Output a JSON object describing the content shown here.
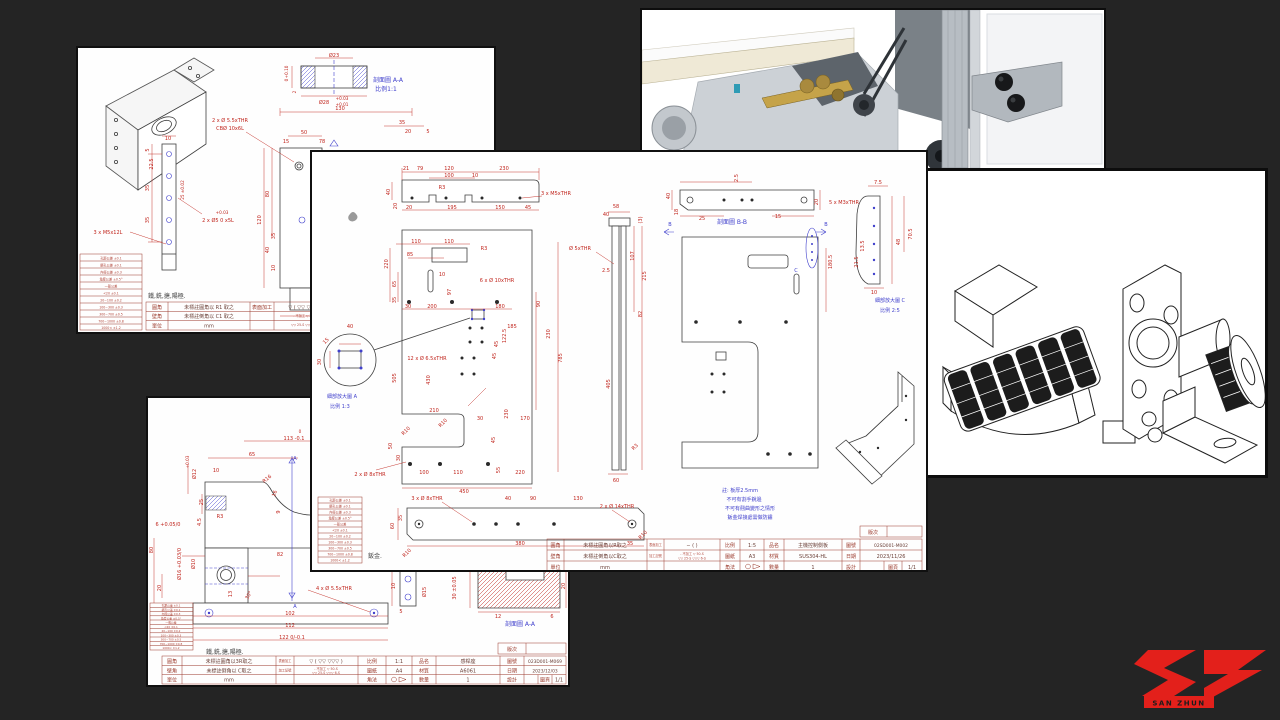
{
  "colors": {
    "background": "#242424",
    "dim_red": "#c0241c",
    "label_blue": "#4040cc",
    "title_maroon": "#9a382a",
    "logo_red": "#e3201b"
  },
  "tol_table": {
    "rows": [
      "孔距公差 ±0.1",
      "鑽孔公差 ±0.1",
      "內徑公差 ±0.3",
      "角度公差 ±0.5°",
      "一般公差",
      "<20 ±0.1",
      "20~100 ±0.2",
      "100~300 ±0.3",
      "300~700 ±0.5",
      "700~1000 ±0.8",
      "1000< ±1.2"
    ]
  },
  "title_labels": {
    "fillet": "圓角",
    "chamfer": "壁角",
    "unit": "單位",
    "surface": "表面加工",
    "machining": "加工記號",
    "scale": "比例",
    "paper": "圖紙",
    "angle": "角法",
    "part": "品名",
    "material": "材質",
    "qty": "數量",
    "dwg_no": "圖號",
    "date": "日期",
    "design": "設計",
    "page": "圖頁",
    "rev": "版次",
    "surface_sym": "▽ ( ▽▽ ▽▽▽ )",
    "codes_a": "- 不加工  ▽ 50-S",
    "codes_b": "▽▽ 25-S  ▽▽▽ 6-S"
  },
  "sheet_top_left": {
    "section_label": "剖面圖 A-A",
    "section_scale": "比例1:1",
    "process_note": "鐵,銑,搪,陽極.",
    "dims_section": [
      "Ø23",
      "+0.10",
      "0",
      "2",
      "Ø28",
      "+0.03",
      "+0.01"
    ],
    "dims_top": [
      "130",
      "50",
      "15",
      "78",
      "35",
      "20",
      "5"
    ],
    "dims_callouts": [
      "2 x Ø 5.5xTHR",
      "CBØ 10x6L",
      "3 x M5x12L",
      "+0.03",
      "2 x Ø5 0  x5L"
    ],
    "dims_strip": [
      "10",
      "5",
      "22.5",
      "35",
      "35",
      "25 ±0.02"
    ],
    "dims_main": [
      "120",
      "80",
      "40",
      "35",
      "10",
      "51 ±0.02",
      "45",
      "19",
      "R7",
      "7",
      "22"
    ],
    "title": {
      "fillet_val": "未標註圓角以 R1 取之",
      "chamfer_val": "未標註倒角以 C1 取之",
      "unit_val": "mm",
      "scale_val": "2:3",
      "paper_val": "A4"
    }
  },
  "sheet_center": {
    "dims_top": [
      "21",
      "79",
      "120",
      "230",
      "100",
      "10",
      "40",
      "20",
      "20",
      "R3",
      "195",
      "150",
      "45",
      "3 x M5xTHR"
    ],
    "dims_main": [
      "110",
      "110",
      "85",
      "R3",
      "220",
      "65",
      "35",
      "10",
      "97",
      "6 x Ø 10xTHR",
      "30",
      "200",
      "180",
      "90",
      "185",
      "45",
      "230",
      "785",
      "12 x Ø 6.5xTHR",
      "122.5",
      "45",
      "505",
      "430",
      "210",
      "R10",
      "R10",
      "30",
      "170",
      "45",
      "230",
      "50",
      "30",
      "2 x Ø 8xTHR",
      "100",
      "110",
      "55",
      "220",
      "450",
      "Ø 5xTHR"
    ],
    "dims_bottom": [
      "3 x Ø 8xTHR",
      "40",
      "90",
      "130",
      "2 x Ø 14xTHR",
      "60",
      "35",
      "380",
      "35",
      "R10",
      "R10"
    ],
    "dims_side": [
      "58",
      "40",
      "(3)",
      "107",
      "215",
      "2.5",
      "82",
      "405",
      "R3",
      "60"
    ],
    "dims_secb": [
      "2.5",
      "40",
      "18",
      "25",
      "15",
      "20"
    ],
    "dims_cplate": [
      "180.5"
    ],
    "dims_detc": [
      "7.5",
      "5 x M3xTHR",
      "13.5",
      "48",
      "70.5",
      "21.5",
      "10"
    ],
    "dims_deta": [
      "40",
      "15",
      "30"
    ],
    "labels": {
      "sec_b": "剖面圖 B-B",
      "det_a": "細部放大圖 A",
      "det_a_s": "比例 1:3",
      "det_c": "細部放大圖 C",
      "det_c_s": "比例 2:5",
      "c": "C",
      "b1": "B",
      "b2": "B",
      "metal": "鈑金."
    },
    "notes": [
      "註: 板厚2.5mm",
      "不可有割手銳邊",
      "不可有翹曲變形之情形",
      "鈑金焊接處需做防鏽"
    ],
    "title": {
      "fillet_val": "未標註圓角以R取之",
      "chamfer_val": "未標註倒角以C取之",
      "unit_val": "mm",
      "surface_val": "∼ (       )",
      "scale_val": "1:5",
      "paper_val": "A3",
      "part_val": "主機控制側板",
      "material_val": "SUS304-HL",
      "qty_val": "1",
      "dwg_no_val": "02SD001-M002",
      "date_val": "2023/11/26",
      "page_val": "1/1"
    }
  },
  "sheet_bottom_left": {
    "process_note": "鐵,銑,搪,陽極.",
    "dims_main": [
      "0",
      "113 -0.1",
      "65",
      "10",
      "Ø12",
      "+0.03",
      "25",
      "R16",
      "16",
      "9",
      "R3",
      "4.5",
      "6 +0.05/0",
      "Ø16 +0.03/0",
      "Ø10",
      "80",
      "20",
      "82",
      "30°",
      "13",
      "102",
      "112",
      "122 0/-0.1",
      "4 x Ø 5.5xTHR"
    ],
    "dims_sec": [
      "10",
      "Ø15",
      "5",
      "30 ±0.05",
      "8",
      "12",
      "6",
      "20"
    ],
    "labels": {
      "sec": "剖面圖 A-A",
      "a1": "A",
      "a2": "A"
    },
    "title": {
      "fillet_val": "未標註圓角以3R取之",
      "chamfer_val": "未標註倒角以 C取之",
      "unit_val": "mm",
      "scale_val": "1:1",
      "paper_val": "A4",
      "part_val": "感桿座",
      "material_val": "A6061",
      "qty_val": "1",
      "dwg_no_val": "023D001-M069",
      "date_val": "2023/12/03",
      "page_val": "1/1"
    }
  },
  "logo": {
    "brand": "SAN ZHUN"
  }
}
